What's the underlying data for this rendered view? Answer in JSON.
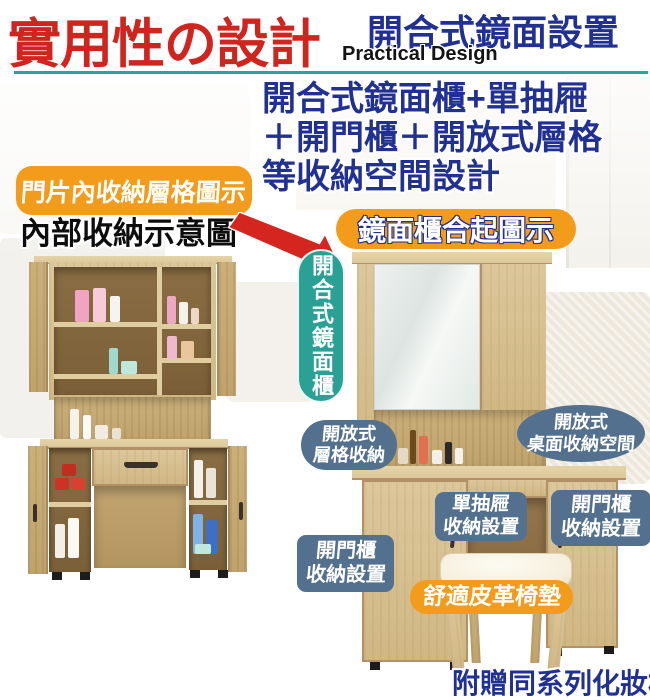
{
  "header": {
    "title": "實用性の設計",
    "feature_title": "開合式鏡面設置",
    "feature_subtitle": "Practical Design"
  },
  "headline": {
    "line1": "開合式鏡面櫃+單抽屜",
    "line2": "＋開門櫃＋開放式層格",
    "line3": "等收納空間設計"
  },
  "left_figure": {
    "badge": "門片內收納層格圖示",
    "caption": "內部收納示意圖"
  },
  "right_figure": {
    "badge": "鏡面櫃合起圖示",
    "vertical_label": "開合式鏡面櫃"
  },
  "callouts": {
    "shelf": {
      "line1": "開放式",
      "line2": "層格收納"
    },
    "desktop": {
      "line1": "開放式",
      "line2": "桌面收納空間"
    },
    "drawer": {
      "line1": "單抽屜",
      "line2": "收納設置"
    },
    "door_right": {
      "line1": "開門櫃",
      "line2": "收納設置"
    },
    "door_left": {
      "line1": "開門櫃",
      "line2": "收納設置"
    },
    "cushion": "舒適皮革椅墊"
  },
  "footer": {
    "note": "附贈同系列化妝椅"
  },
  "icons": {
    "arrow": "red-arrow-down-right"
  },
  "colors": {
    "title_red": "#d0251f",
    "navy": "#203093",
    "teal_line": "#2aa39a",
    "teal_pill": "#2ba095",
    "orange": "#f39b1a",
    "slate": "#53718e"
  }
}
